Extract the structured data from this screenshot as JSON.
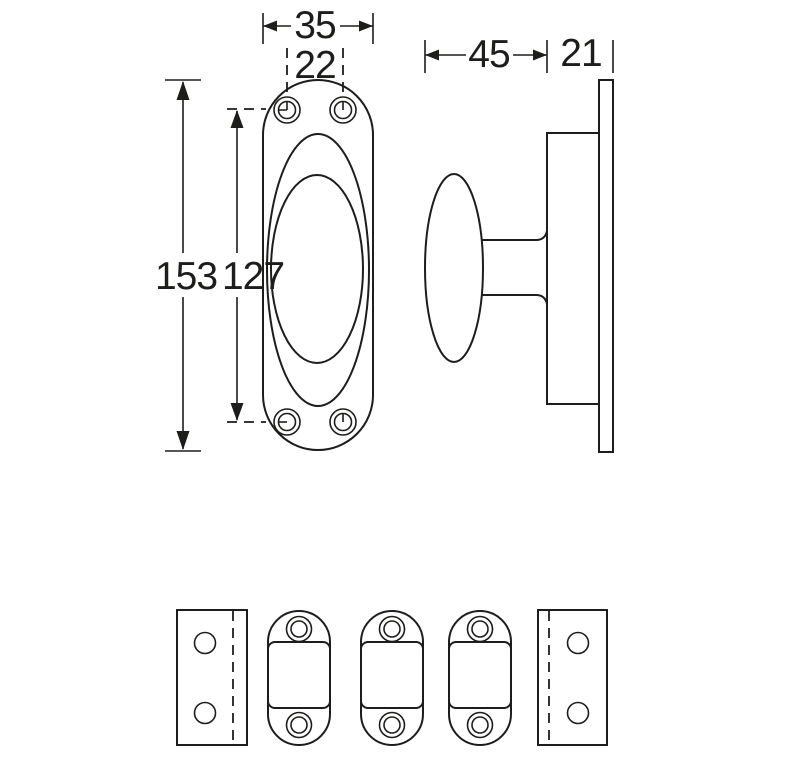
{
  "title": "Technical drawing of oval-rosette window knob with mounting plates",
  "colors": {
    "background": "#ffffff",
    "line": "#1d1d1b"
  },
  "dimensions": {
    "plate_width": "35",
    "hole_spacing": "22",
    "plate_height": "153",
    "hole_distance": "127",
    "knob_projection": "45",
    "plate_thickness": "21"
  }
}
